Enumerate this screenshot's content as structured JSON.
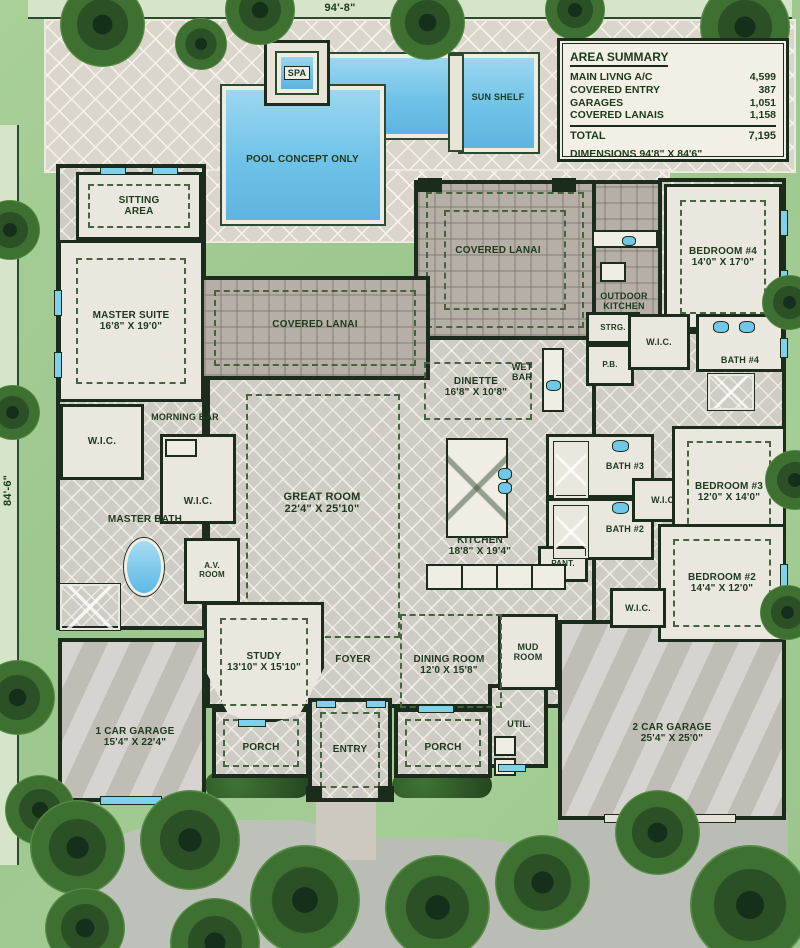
{
  "site": {
    "top_dimension": "94'-8\"",
    "left_dimension": "84'-6\""
  },
  "area_summary": {
    "title": "AREA SUMMARY",
    "rows": [
      {
        "label": "MAIN LIVNG A/C",
        "value": "4,599"
      },
      {
        "label": "COVERED ENTRY",
        "value": "387"
      },
      {
        "label": "GARAGES",
        "value": "1,051"
      },
      {
        "label": "COVERED LANAIS",
        "value": "1,158"
      }
    ],
    "total_label": "TOTAL",
    "total_value": "7,195",
    "dimensions_note": "DIMENSIONS 94'8\" X 84'6\""
  },
  "pool": {
    "spa_label": "SPA",
    "sun_shelf_label": "SUN SHELF",
    "concept_label": "POOL CONCEPT ONLY"
  },
  "rooms": {
    "sitting_area": {
      "name": "SITTING AREA"
    },
    "master_suite": {
      "name": "MASTER SUITE",
      "dims": "16'8\" X 19'0\""
    },
    "wic_master_left": {
      "name": "W.I.C."
    },
    "wic_master_right": {
      "name": "W.I.C."
    },
    "morning_bar": {
      "name": "MORNING BAR"
    },
    "master_bath": {
      "name": "MASTER BATH"
    },
    "av_room": {
      "name": "A.V. ROOM"
    },
    "covered_lanai_left": {
      "name": "COVERED LANAI"
    },
    "covered_lanai_center": {
      "name": "COVERED LANAI"
    },
    "outdoor_kitchen": {
      "name": "OUTDOOR KITCHEN"
    },
    "strg": {
      "name": "STRG."
    },
    "pb": {
      "name": "P.B."
    },
    "wic_bedroom4": {
      "name": "W.I.C."
    },
    "bath4": {
      "name": "BATH #4"
    },
    "bedroom4": {
      "name": "BEDROOM #4",
      "dims": "14'0\" X 17'0\""
    },
    "wet_bar": {
      "name": "WET BAR"
    },
    "dinette": {
      "name": "DINETTE",
      "dims": "16'8\" X 10'8\""
    },
    "great_room": {
      "name": "GREAT ROOM",
      "dims": "22'4\" X 25'10\""
    },
    "kitchen": {
      "name": "KITCHEN",
      "dims": "18'8\" X 19'4\""
    },
    "bath3": {
      "name": "BATH #3"
    },
    "bedroom3": {
      "name": "BEDROOM #3",
      "dims": "12'0\" X 14'0\""
    },
    "wic_bedroom3": {
      "name": "W.I.C."
    },
    "bath2": {
      "name": "BATH #2"
    },
    "pantry": {
      "name": "PANT."
    },
    "bedroom2": {
      "name": "BEDROOM #2",
      "dims": "14'4\" X 12'0\""
    },
    "wic_bedroom2": {
      "name": "W.I.C."
    },
    "mud_room": {
      "name": "MUD ROOM"
    },
    "util": {
      "name": "UTIL."
    },
    "garage2": {
      "name": "2 CAR GARAGE",
      "dims": "25'4\" X 25'0\""
    },
    "study": {
      "name": "STUDY",
      "dims": "13'10\" X 15'10\""
    },
    "foyer": {
      "name": "FOYER"
    },
    "dining_room": {
      "name": "DINING ROOM",
      "dims": "12'0 X 15'8\""
    },
    "garage1": {
      "name": "1 CAR GARAGE",
      "dims": "15'4\" X 22'4\""
    },
    "porch_left": {
      "name": "PORCH"
    },
    "entry": {
      "name": "ENTRY"
    },
    "porch_right": {
      "name": "PORCH"
    }
  },
  "colors": {
    "wall_dark": "#1b2c1c",
    "label_green": "#1c3a1c",
    "pool_blue": "#6fc2e8",
    "fixture_blue": "#5cb8e6",
    "deck_tile": "#dad6cb",
    "lanai_paver": "#b6afa6",
    "landscape_green": "#9cc78e"
  }
}
